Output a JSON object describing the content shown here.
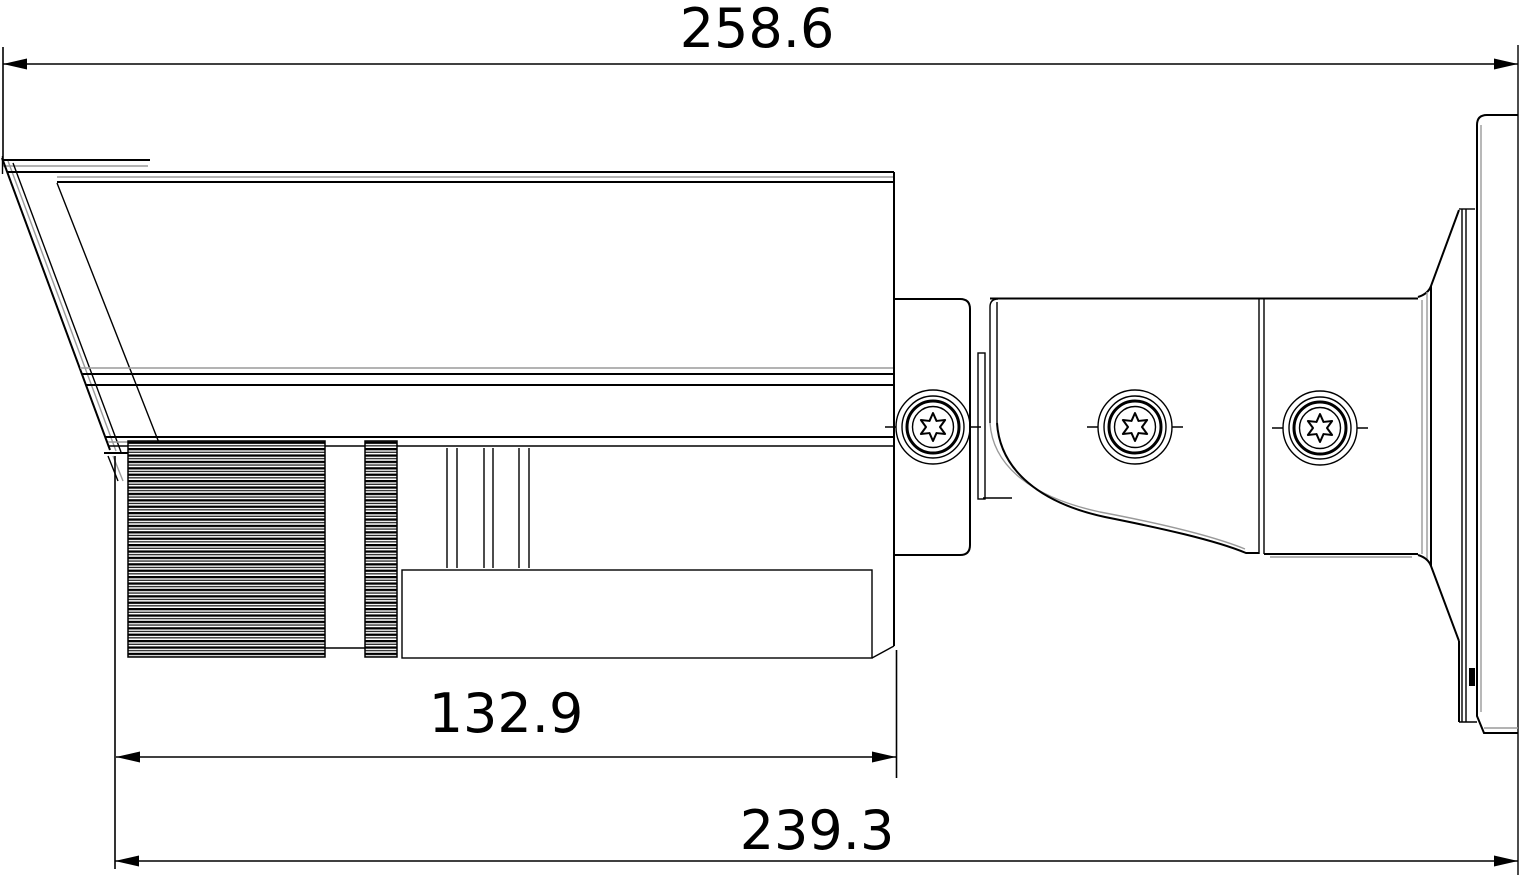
{
  "drawing": {
    "type": "technical-dimension-drawing",
    "subject": "bullet-security-camera-side-view",
    "background": "#ffffff",
    "line_color": "#000000",
    "shadow_line_color": "#9a9a9a",
    "dimensions": {
      "overall_length": "258.6",
      "front_section_length": "132.9",
      "body_to_wall_length": "239.3"
    },
    "components": [
      "sunshade",
      "camera-body",
      "lens-focus-ring",
      "lens-zoom-ring",
      "mounting-bracket",
      "torx-screws",
      "mount-base-cone",
      "wall-mount-flange"
    ]
  }
}
